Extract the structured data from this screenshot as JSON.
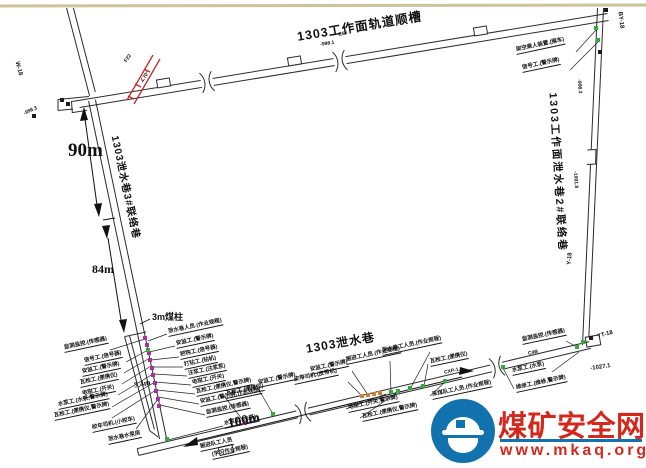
{
  "watermark": {
    "site_name": "煤矿安全网",
    "url": "www.mkaq.org",
    "brand_red": "#d3281e",
    "brand_blue": "#1272ae"
  },
  "tunnel_labels": {
    "track_gateway": "1303工作面轨道顺槽",
    "right_link": "1303工作面泄水巷2#联络巷",
    "left_link": "1303泄水巷3#联络巷",
    "drain_main": "1303泄水巷"
  },
  "measurements": {
    "seg1": "90m",
    "seg2": "84m",
    "seg3": "100m",
    "gap": "7.4m",
    "pillar": "3m煤柱"
  },
  "marker_colors": {
    "p": "#a8309f",
    "g": "#35a93c",
    "o": "#c8823c",
    "k": "#1a1a1a"
  },
  "fault_color": "#c62828",
  "annotations": [
    {
      "t": "监测监控.(传感器)",
      "x": 64,
      "y": 346,
      "ldr": [
        110,
        350,
        145,
        339
      ]
    },
    {
      "t": "信号工.(信号器)",
      "x": 84,
      "y": 359,
      "ldr": [
        126,
        362,
        148,
        350
      ]
    },
    {
      "t": "安监工.(警示牌)",
      "x": 82,
      "y": 370,
      "ldr": [
        124,
        373,
        150,
        358
      ]
    },
    {
      "t": "瓦检工.(便携仪)",
      "x": 80,
      "y": 381,
      "ldr": [
        122,
        384,
        151,
        366
      ]
    },
    {
      "t": "电钳工.(开关)",
      "x": 82,
      "y": 392,
      "ldr": [
        118,
        395,
        153,
        374
      ]
    },
    {
      "t": "水泵工.(水泵,警示牌)",
      "x": 58,
      "y": 403,
      "ldr": [
        112,
        407,
        155,
        382
      ]
    },
    {
      "t": "瓦检工.(便携仪,警示牌)",
      "x": 54,
      "y": 414,
      "ldr": [
        112,
        418,
        156,
        390
      ]
    },
    {
      "t": "绞车司机.(小绞车)",
      "x": 92,
      "y": 426,
      "ldr": [
        136,
        429,
        158,
        399
      ]
    },
    {
      "t": "泄水巷水泵房",
      "x": 108,
      "y": 438
    },
    {
      "t": "泄水巷人员.(作业规程)",
      "x": 168,
      "y": 330,
      "ldr": [
        167,
        334,
        148,
        341
      ]
    },
    {
      "t": "安监工.(警示牌)",
      "x": 176,
      "y": 342,
      "ldr": [
        175,
        346,
        149,
        352
      ]
    },
    {
      "t": "把钩工.(信号器)",
      "x": 180,
      "y": 353,
      "ldr": [
        179,
        357,
        151,
        360
      ]
    },
    {
      "t": "打钻工.(钻机)",
      "x": 184,
      "y": 363,
      "ldr": [
        183,
        367,
        152,
        367
      ]
    },
    {
      "t": "注浆工.(注浆泵)",
      "x": 188,
      "y": 372,
      "ldr": [
        187,
        376,
        154,
        374
      ]
    },
    {
      "t": "电钳工.(开关)",
      "x": 192,
      "y": 381,
      "ldr": [
        191,
        385,
        155,
        382
      ]
    },
    {
      "t": "瓦检工.(便携仪,警示牌)",
      "x": 196,
      "y": 390,
      "ldr": [
        195,
        394,
        157,
        390
      ]
    },
    {
      "t": "安监工.(警示牌,作业规程)",
      "x": 200,
      "y": 400,
      "ldr": [
        199,
        404,
        158,
        397
      ]
    },
    {
      "t": "监测监控.(传感器)",
      "x": 206,
      "y": 411,
      "ldr": [
        205,
        415,
        160,
        405
      ]
    },
    {
      "t": "水泵工.(水泵)",
      "x": 224,
      "y": 422,
      "ldr": [
        223,
        426,
        168,
        440
      ]
    },
    {
      "t": "掘进队工人员",
      "x": 200,
      "y": 445
    },
    {
      "t": "(学习作业规程)",
      "x": 212,
      "y": 453
    },
    {
      "t": "瓦检工.(便携仪)",
      "x": 226,
      "y": 392,
      "ldr": [
        224,
        396,
        245,
        423
      ]
    },
    {
      "t": "安监工.(警示牌)",
      "x": 258,
      "y": 381,
      "ldr": [
        256,
        385,
        273,
        414
      ]
    },
    {
      "t": "皮带司机.(皮带机)",
      "x": 294,
      "y": 378,
      "ldr": [
        348,
        382,
        362,
        396
      ]
    },
    {
      "t": "安监工.(警示牌)",
      "x": 310,
      "y": 368,
      "ldr": [
        352,
        371,
        368,
        395
      ]
    },
    {
      "t": "掘进工人员.(作业规程)",
      "x": 346,
      "y": 358,
      "ldr": [
        390,
        361,
        391,
        392
      ]
    },
    {
      "t": "泄水巷工人员.(作业规程)",
      "x": 382,
      "y": 349,
      "ldr": [
        430,
        352,
        410,
        389
      ]
    },
    {
      "t": "瓦检工.(便携仪)",
      "x": 430,
      "y": 360,
      "ldr": [
        428,
        364,
        424,
        386
      ]
    },
    {
      "t": "电钳工.(开关,警示牌)",
      "x": 348,
      "y": 406,
      "ldr": [
        346,
        409,
        386,
        394
      ]
    },
    {
      "t": "瓦检工.(便携仪,警示牌)",
      "x": 362,
      "y": 415,
      "ldr": [
        360,
        418,
        398,
        392
      ]
    },
    {
      "t": "采煤队工人员.(作业规程)",
      "x": 432,
      "y": 393,
      "ldr": [
        430,
        396,
        445,
        382
      ]
    },
    {
      "t": "维修工.(维修,警示牌)",
      "x": 516,
      "y": 386,
      "ldr": [
        514,
        389,
        503,
        368
      ]
    },
    {
      "t": "监测监控.(传感器)",
      "x": 522,
      "y": 338,
      "ldr": [
        566,
        341,
        577,
        347
      ]
    },
    {
      "t": "水泵工.(水泵)",
      "x": 512,
      "y": 369,
      "ldr": [
        552,
        372,
        579,
        352
      ]
    },
    {
      "t": "架空乘人装置.(猴车)",
      "x": 516,
      "y": 48,
      "ldr": [
        576,
        52,
        596,
        30
      ]
    },
    {
      "t": "信号工.(警示牌)",
      "x": 522,
      "y": 66,
      "ldr": [
        570,
        70,
        598,
        42
      ]
    },
    {
      "t": "W-18",
      "x": 16,
      "y": 58,
      "r": 75,
      "fs": 6,
      "cls": "st"
    },
    {
      "t": "BY-18",
      "x": 619,
      "y": 8,
      "r": 83,
      "fs": 6,
      "cls": "st"
    },
    {
      "t": "Y-18",
      "x": 570,
      "y": 262,
      "r": -85,
      "fs": 6,
      "cls": "st"
    },
    {
      "t": "YT-18",
      "x": 597,
      "y": 334,
      "r": -15,
      "fs": 6,
      "cls": "st"
    },
    {
      "t": "-1027.1",
      "x": 590,
      "y": 366,
      "r": -8,
      "fs": 6,
      "cls": "st"
    },
    {
      "t": "-998.3",
      "x": 578,
      "y": 76,
      "r": 86,
      "fs": 5,
      "cls": "st"
    },
    {
      "t": "-1001.8",
      "x": 574,
      "y": 168,
      "r": 86,
      "fs": 5,
      "cls": "st"
    },
    {
      "t": "-998.3",
      "x": 24,
      "y": 112,
      "r": -25,
      "fs": 5,
      "cls": "st"
    },
    {
      "t": "-998.1",
      "x": 320,
      "y": 43,
      "r": -9,
      "fs": 5,
      "cls": "st"
    },
    {
      "t": "C5#",
      "x": 338,
      "y": 33,
      "r": -9,
      "fs": 5,
      "cls": "st"
    },
    {
      "t": "C4B",
      "x": 528,
      "y": 352,
      "r": -13,
      "fs": 5,
      "cls": "st"
    },
    {
      "t": "CXP-1",
      "x": 444,
      "y": 371,
      "r": -13,
      "fs": 5,
      "cls": "st"
    },
    {
      "t": "∠70°",
      "x": 142,
      "y": 80,
      "r": -55,
      "fs": 5,
      "cls": "st"
    },
    {
      "t": "F22",
      "x": 126,
      "y": 60,
      "r": -55,
      "fs": 5,
      "cls": "st"
    }
  ],
  "markers": [
    {
      "x": 145,
      "y": 338,
      "c": "p"
    },
    {
      "x": 147,
      "y": 345,
      "c": "p"
    },
    {
      "x": 149,
      "y": 353,
      "c": "p"
    },
    {
      "x": 150,
      "y": 360,
      "c": "p"
    },
    {
      "x": 152,
      "y": 368,
      "c": "p"
    },
    {
      "x": 153,
      "y": 375,
      "c": "p"
    },
    {
      "x": 155,
      "y": 383,
      "c": "p"
    },
    {
      "x": 156,
      "y": 391,
      "c": "p"
    },
    {
      "x": 158,
      "y": 399,
      "c": "p"
    },
    {
      "x": 159,
      "y": 406,
      "c": "p"
    },
    {
      "x": 245,
      "y": 423,
      "c": "p"
    },
    {
      "x": 148,
      "y": 350,
      "c": "g"
    },
    {
      "x": 167,
      "y": 439,
      "c": "g"
    },
    {
      "x": 273,
      "y": 414,
      "c": "g"
    },
    {
      "x": 391,
      "y": 392,
      "c": "g"
    },
    {
      "x": 398,
      "y": 391,
      "c": "g"
    },
    {
      "x": 410,
      "y": 388,
      "c": "g"
    },
    {
      "x": 423,
      "y": 386,
      "c": "g"
    },
    {
      "x": 445,
      "y": 381,
      "c": "g"
    },
    {
      "x": 503,
      "y": 367,
      "c": "g"
    },
    {
      "x": 577,
      "y": 347,
      "c": "g"
    },
    {
      "x": 583,
      "y": 342,
      "c": "g"
    },
    {
      "x": 596,
      "y": 28,
      "c": "g"
    },
    {
      "x": 598,
      "y": 40,
      "c": "g"
    },
    {
      "x": 362,
      "y": 396,
      "c": "o"
    },
    {
      "x": 368,
      "y": 395,
      "c": "o"
    },
    {
      "x": 374,
      "y": 394,
      "c": "o"
    },
    {
      "x": 380,
      "y": 393,
      "c": "o"
    },
    {
      "x": 600,
      "y": 52,
      "c": "k"
    },
    {
      "x": 606,
      "y": 10,
      "c": "k"
    },
    {
      "x": 62,
      "y": 100,
      "c": "k"
    },
    {
      "x": 68,
      "y": 104,
      "c": "k"
    },
    {
      "x": 591,
      "y": 338,
      "c": "k"
    },
    {
      "x": 34,
      "y": 116,
      "c": "k"
    }
  ]
}
